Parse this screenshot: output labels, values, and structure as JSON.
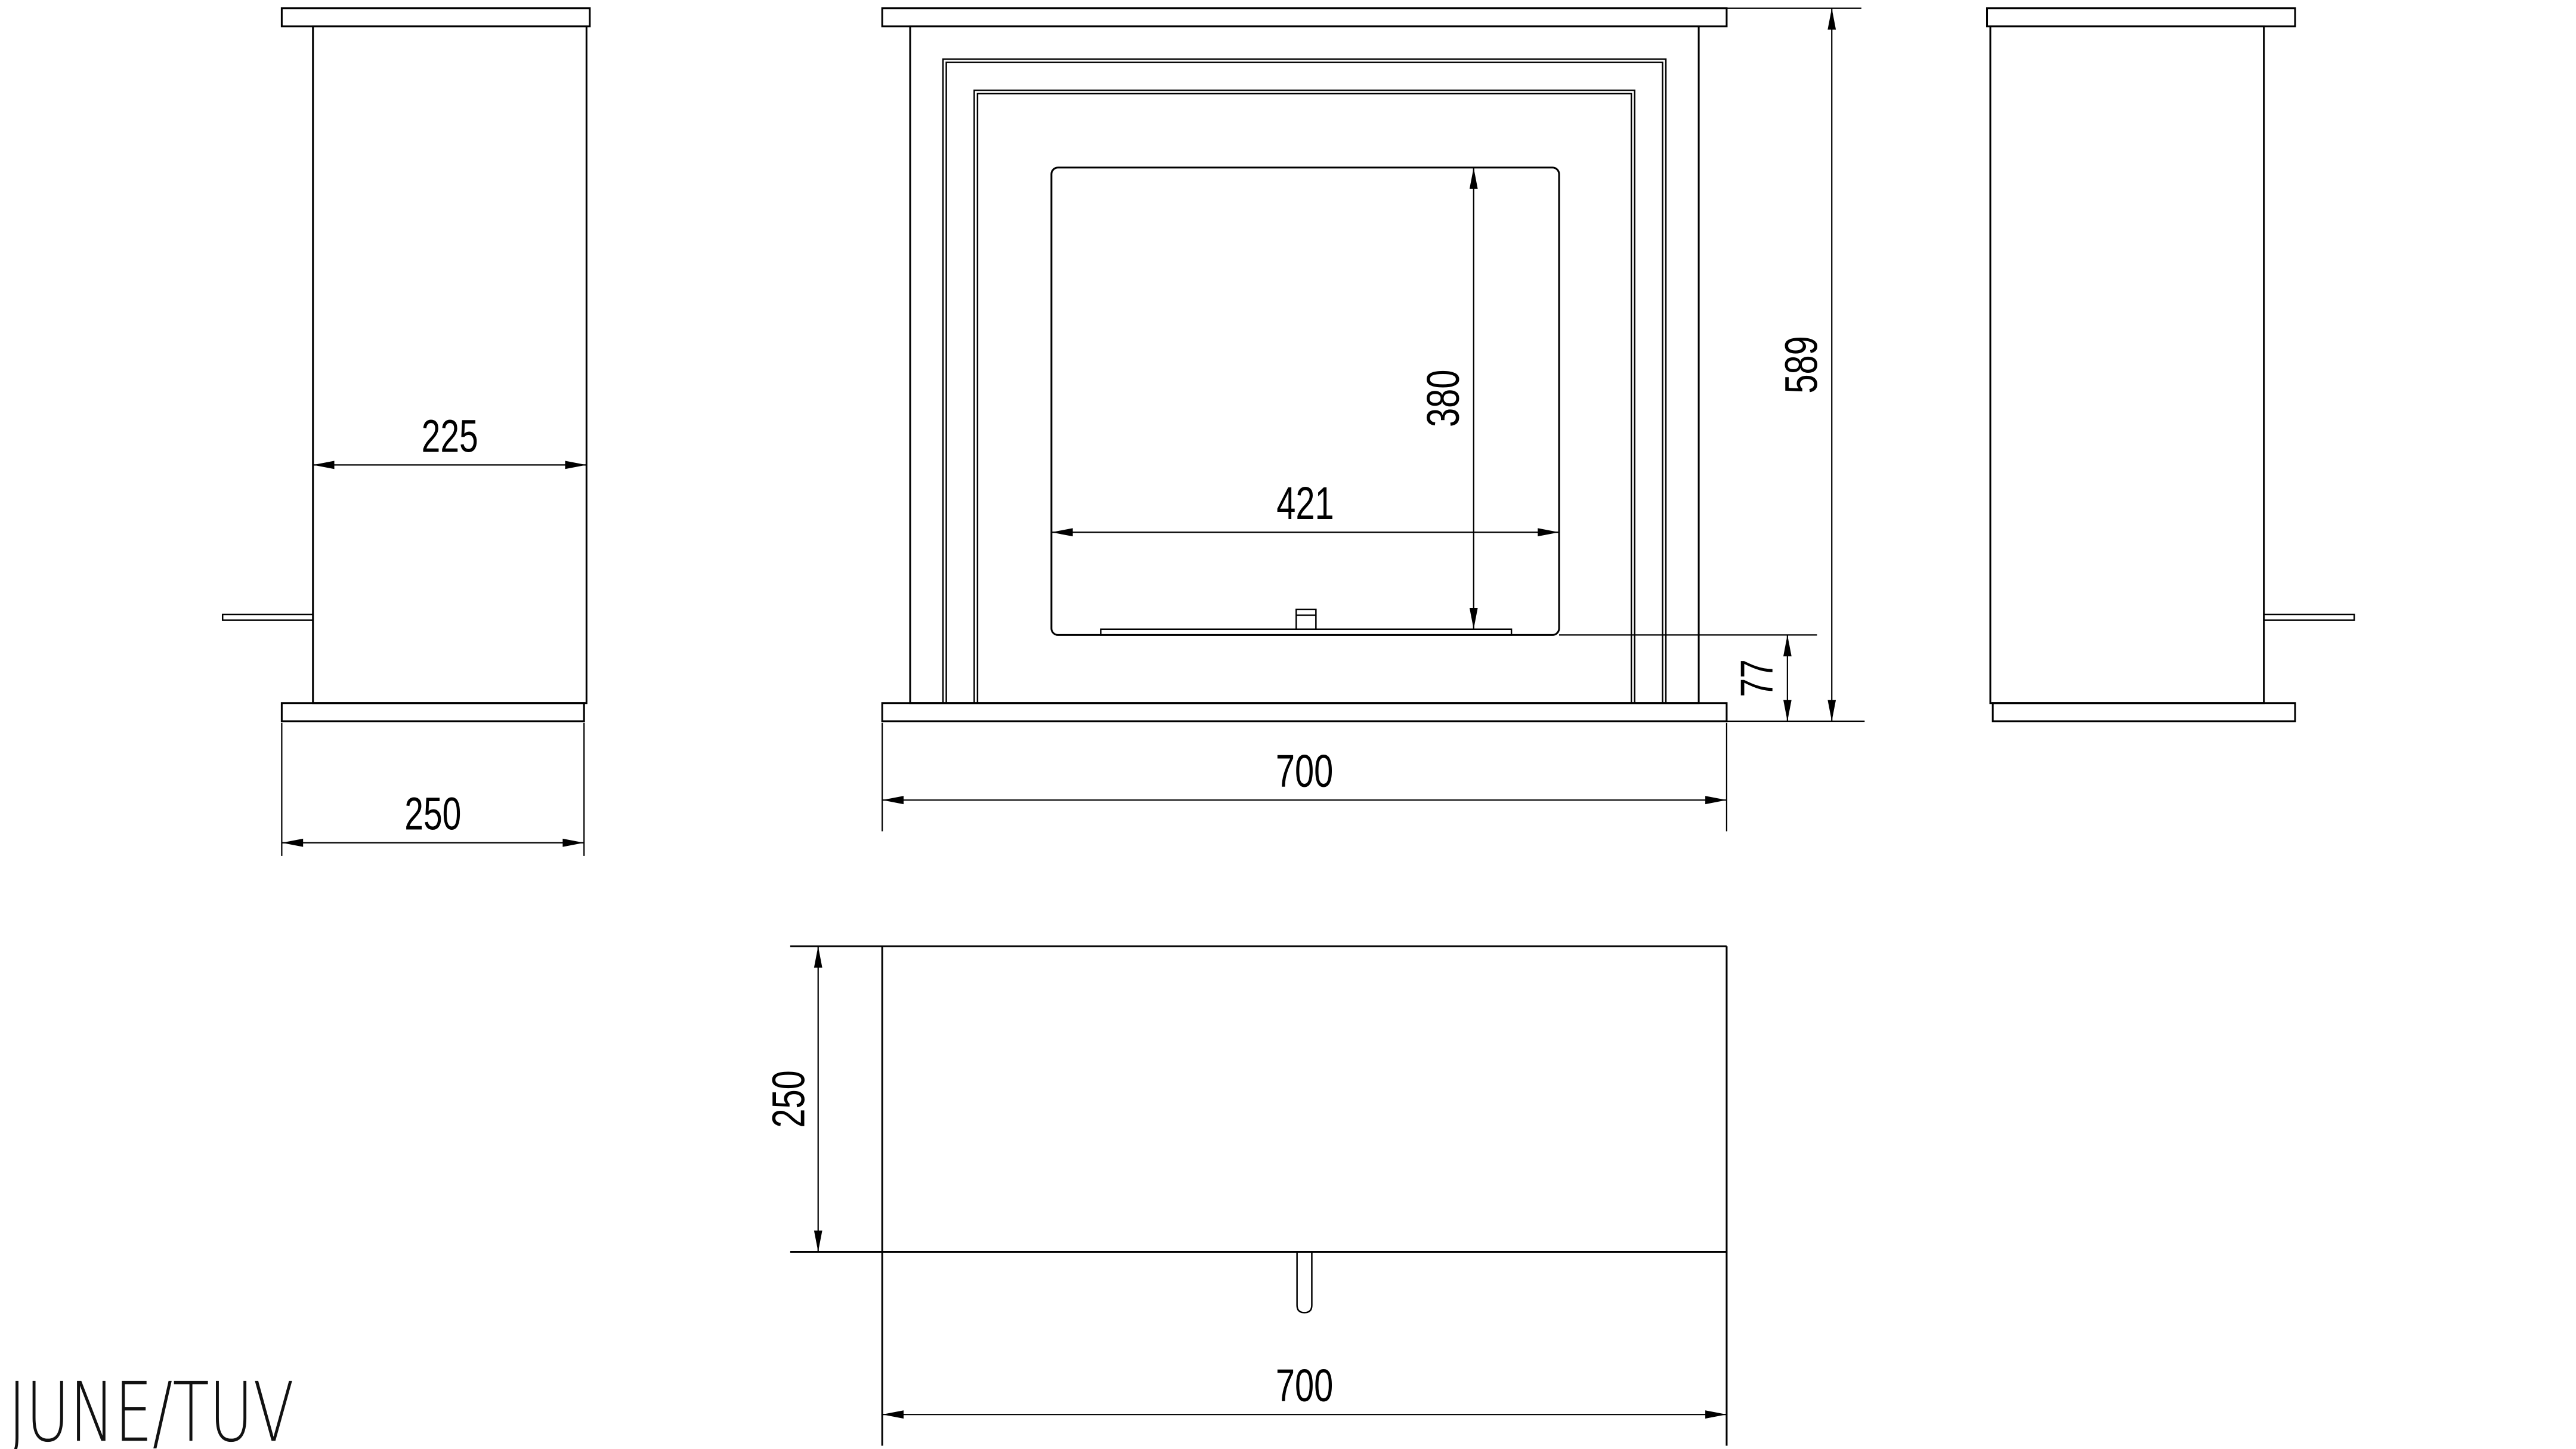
{
  "title": "JUNE/TUV",
  "dims": {
    "side_width": "225",
    "side_base_depth": "250",
    "opening_width": "421",
    "opening_height": "380",
    "overall_height": "589",
    "base_height": "77",
    "overall_width": "700",
    "plan_depth": "250",
    "plan_width": "700"
  },
  "colors": {
    "line": "#000000",
    "background": "#ffffff"
  }
}
